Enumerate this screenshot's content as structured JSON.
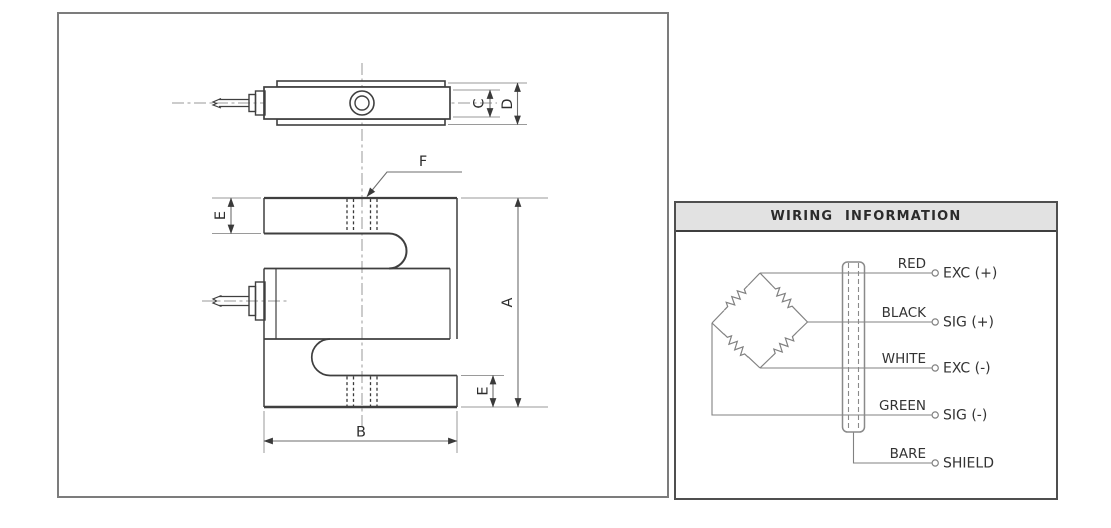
{
  "drawing_panel": {
    "dim_labels": {
      "A": "A",
      "B": "B",
      "C": "C",
      "D": "D",
      "E_top": "E",
      "E_bottom": "E",
      "F": "F"
    }
  },
  "wiring_panel": {
    "title": "WIRING INFORMATION",
    "wires": [
      {
        "color": "RED",
        "terminal": "EXC (+)"
      },
      {
        "color": "BLACK",
        "terminal": "SIG (+)"
      },
      {
        "color": "WHITE",
        "terminal": "EXC (-)"
      },
      {
        "color": "GREEN",
        "terminal": "SIG (-)"
      },
      {
        "color": "BARE",
        "terminal": "SHIELD"
      }
    ]
  },
  "colors": {
    "part_line": "#3f3f3f",
    "dimension_line": "#6e6e6e",
    "extension_line": "#9a9a9a",
    "center_line": "#999999",
    "wiring_line": "#818181",
    "header_background": "#e2e2e2",
    "panel_border": "#7c7c7c"
  }
}
